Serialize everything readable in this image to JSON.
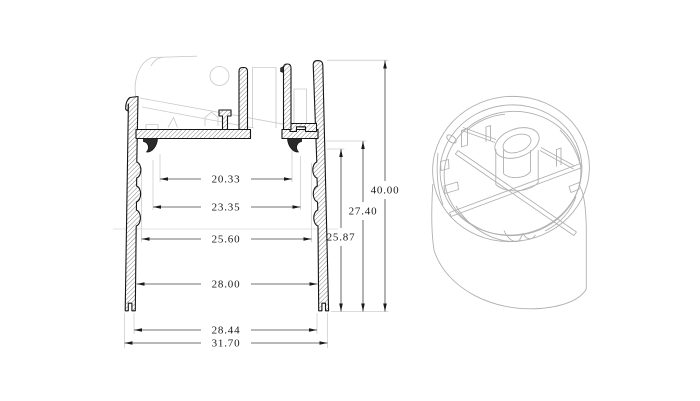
{
  "dims": {
    "horizontal": [
      {
        "label": "20.33"
      },
      {
        "label": "23.35"
      },
      {
        "label": "25.60"
      },
      {
        "label": "28.00"
      },
      {
        "label": "28.44"
      },
      {
        "label": "31.70"
      }
    ],
    "vertical": [
      {
        "label": "25.87"
      },
      {
        "label": "27.40"
      },
      {
        "label": "40.00"
      }
    ]
  },
  "colors": {
    "background": "#ffffff",
    "section_outline": "#151515",
    "hatch_line": "#6a6a6a",
    "dimension_line": "#454545",
    "extension_line": "#b8b8b8",
    "ghost_line": "#cbcbcb",
    "isometric_line": "#b0b0b0",
    "text": "#1a1a1a"
  }
}
